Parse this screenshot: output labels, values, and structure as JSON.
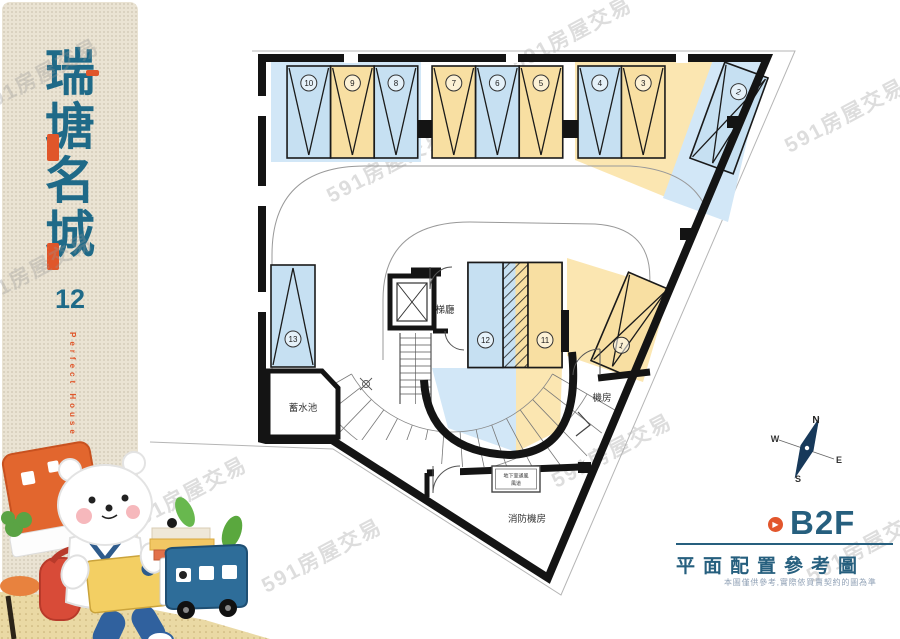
{
  "watermark": {
    "text": "591房屋交易"
  },
  "sidebar": {
    "title_chars": [
      "瑞",
      "塘",
      "名",
      "城"
    ],
    "number": "12",
    "subtitle": "Perfect House"
  },
  "plan": {
    "labels": {
      "elevator_hall": "梯廳",
      "water_tank": "蓄水池",
      "machine_room": "機房",
      "fire_machine_room": "消防機房",
      "vent_line1": "地下室通風",
      "vent_line2": "風道"
    },
    "compass": {
      "n": "N",
      "s": "S",
      "e": "E",
      "w": "W"
    },
    "colors": {
      "stall_blue": "#c6e0f2",
      "stall_yellow": "#f8dfa2",
      "pad_blue": "#d2e7f7",
      "pad_yellow": "#fbe6b1",
      "wall": "#141414",
      "teal": "#265f7e",
      "orange": "#e2562c"
    },
    "stalls": [
      {
        "no": "10",
        "cx": 308.8,
        "cy": 112,
        "w": 43.5,
        "h": 92,
        "rot": 0,
        "fill": "blue",
        "v": "down",
        "num_dy": -29
      },
      {
        "no": "9",
        "cx": 352.4,
        "cy": 112,
        "w": 43.5,
        "h": 92,
        "rot": 0,
        "fill": "yellow",
        "v": "down",
        "num_dy": -29
      },
      {
        "no": "8",
        "cx": 396,
        "cy": 112,
        "w": 43.5,
        "h": 92,
        "rot": 0,
        "fill": "blue",
        "v": "down",
        "num_dy": -29
      },
      {
        "no": "7",
        "cx": 453.8,
        "cy": 112,
        "w": 43.5,
        "h": 92,
        "rot": 0,
        "fill": "yellow",
        "v": "down",
        "num_dy": -29
      },
      {
        "no": "6",
        "cx": 497.4,
        "cy": 112,
        "w": 43.5,
        "h": 92,
        "rot": 0,
        "fill": "blue",
        "v": "down",
        "num_dy": -29
      },
      {
        "no": "5",
        "cx": 541,
        "cy": 112,
        "w": 43.5,
        "h": 92,
        "rot": 0,
        "fill": "yellow",
        "v": "down",
        "num_dy": -29
      },
      {
        "no": "4",
        "cx": 599.8,
        "cy": 112,
        "w": 43.5,
        "h": 92,
        "rot": 0,
        "fill": "blue",
        "v": "down",
        "num_dy": -29
      },
      {
        "no": "3",
        "cx": 643.2,
        "cy": 112,
        "w": 43.5,
        "h": 92,
        "rot": 0,
        "fill": "yellow",
        "v": "down",
        "num_dy": -29
      },
      {
        "no": "2",
        "cx": 729,
        "cy": 118,
        "w": 46,
        "h": 102,
        "rot": 20,
        "fill": "blue",
        "v": "down",
        "diag": true,
        "num_dy": -28
      },
      {
        "no": "1",
        "cx": 630,
        "cy": 325,
        "w": 44,
        "h": 96,
        "rot": 23,
        "fill": "yellow",
        "v": "down",
        "diag": true,
        "num_dy": 22
      },
      {
        "no": "13",
        "cx": 293,
        "cy": 316,
        "w": 44,
        "h": 102,
        "rot": 0,
        "fill": "blue",
        "v": "up",
        "num_dy": 23
      },
      {
        "no": "12",
        "cx": 485.5,
        "cy": 315,
        "w": 35,
        "h": 105,
        "rot": 0,
        "fill": "blue",
        "v": "none",
        "num_dy": 25
      },
      {
        "no": "11",
        "cx": 545,
        "cy": 315,
        "w": 34,
        "h": 105,
        "rot": 0,
        "fill": "yellow",
        "v": "none",
        "num_dy": 25
      }
    ]
  },
  "footer": {
    "floor_label": "B2F",
    "plan_title": "平面配置參考圖",
    "disclaimer": "本圖僅供參考,實際依買賣契約的圖為準"
  }
}
